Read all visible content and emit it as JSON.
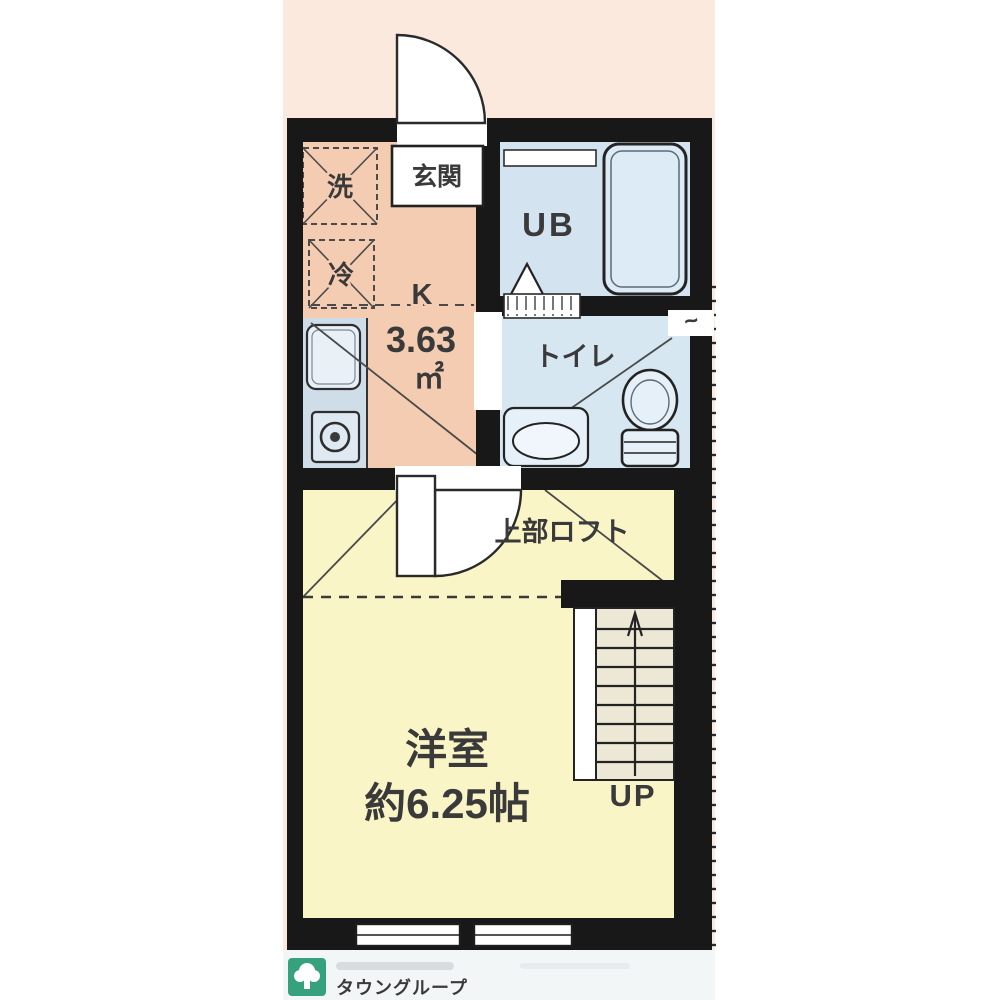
{
  "floorplan": {
    "colors": {
      "surround_pink": "#fce9de",
      "wall": "#181818",
      "kitchen_floor": "#f4ccb2",
      "bath_floor": "#d3e4f0",
      "toilet_floor": "#d6e7f2",
      "room_floor": "#faf5c6",
      "stairs_tread": "#ece8d5",
      "counter": "#cfdde9",
      "label_text": "#3a3a3a"
    },
    "entrance": {
      "label": "玄関"
    },
    "kitchen": {
      "label": "K",
      "area_value": "3.63",
      "area_unit": "㎡",
      "washer_label": "洗",
      "fridge_label": "冷"
    },
    "unit_bath": {
      "label": "UB"
    },
    "toilet": {
      "label": "トイレ"
    },
    "western_room": {
      "label": "洋室",
      "size_label": "約6.25帖"
    },
    "loft": {
      "label": "上部ロフト"
    },
    "stairs": {
      "direction_label": "UP"
    },
    "wall_mark": "~"
  },
  "footer": {
    "brand": "タウングループ",
    "brand_color": "#2e9d79"
  }
}
